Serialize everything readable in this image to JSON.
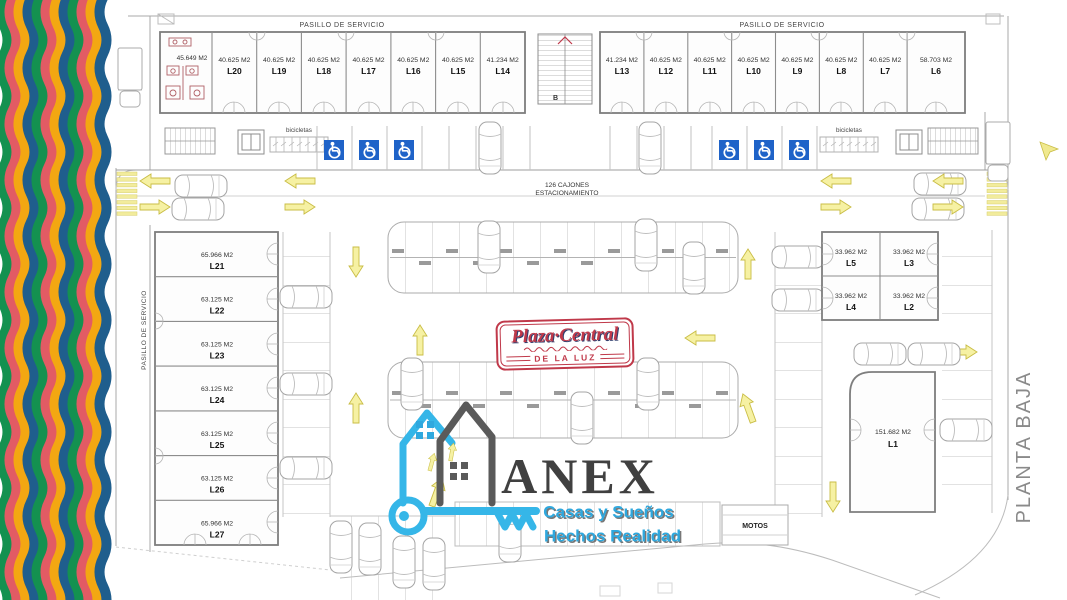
{
  "plan": {
    "title_right": "PLANTA BAJA",
    "service_corridor_top_left": "PASILLO DE SERVICIO",
    "service_corridor_top_right": "PASILLO DE SERVICIO",
    "service_corridor_left": "PASILLO DE SERVICIO",
    "parking_count_line1": "126 CAJONES",
    "parking_count_line2": "ESTACIONAMIENTO",
    "motos_label": "MOTOS",
    "bikes_left_label": "bicicletas",
    "bikes_right_label": "bicicletas",
    "stair_label": "B"
  },
  "units": {
    "restroom_area": "45.649 M2",
    "top_left": [
      {
        "label": "L20",
        "area": "40.625 M2"
      },
      {
        "label": "L19",
        "area": "40.625 M2"
      },
      {
        "label": "L18",
        "area": "40.625 M2"
      },
      {
        "label": "L17",
        "area": "40.625 M2"
      },
      {
        "label": "L16",
        "area": "40.625 M2"
      },
      {
        "label": "L15",
        "area": "40.625 M2"
      },
      {
        "label": "L14",
        "area": "41.234 M2"
      }
    ],
    "top_right": [
      {
        "label": "L13",
        "area": "41.234 M2"
      },
      {
        "label": "L12",
        "area": "40.625 M2"
      },
      {
        "label": "L11",
        "area": "40.625 M2"
      },
      {
        "label": "L10",
        "area": "40.625 M2"
      },
      {
        "label": "L9",
        "area": "40.625 M2"
      },
      {
        "label": "L8",
        "area": "40.625 M2"
      },
      {
        "label": "L7",
        "area": "40.625 M2"
      },
      {
        "label": "L6",
        "area": "58.703 M2"
      }
    ],
    "west": [
      {
        "label": "L21",
        "area": "65.966 M2"
      },
      {
        "label": "L22",
        "area": "63.125 M2"
      },
      {
        "label": "L23",
        "area": "63.125 M2"
      },
      {
        "label": "L24",
        "area": "63.125 M2"
      },
      {
        "label": "L25",
        "area": "63.125 M2"
      },
      {
        "label": "L26",
        "area": "63.125 M2"
      },
      {
        "label": "L27",
        "area": "65.966 M2"
      }
    ],
    "east_block": [
      {
        "label": "L5",
        "area": "33.962 M2"
      },
      {
        "label": "L3",
        "area": "33.962 M2"
      },
      {
        "label": "L4",
        "area": "33.962 M2"
      },
      {
        "label": "L2",
        "area": "33.962 M2"
      }
    ],
    "anchor": {
      "label": "L1",
      "area": "151.682 M2"
    }
  },
  "logos": {
    "plaza": {
      "name": "Plaza·Central",
      "subtitle": "DE LA LUZ"
    },
    "anex": {
      "name": "ANEX",
      "tagline1": "Casas y Sueños",
      "tagline2": "Hechos Realidad"
    }
  },
  "colors": {
    "accent_red": "#c0394a",
    "accent_blue": "#2fa8de",
    "handicap_blue": "#1f63c8",
    "arrow_yellow": "#f6f1a3",
    "stripe_green": "#149150",
    "stripe_coral": "#e25b64",
    "stripe_yellow": "#f3a712",
    "stripe_blue": "#1f5e8d"
  }
}
